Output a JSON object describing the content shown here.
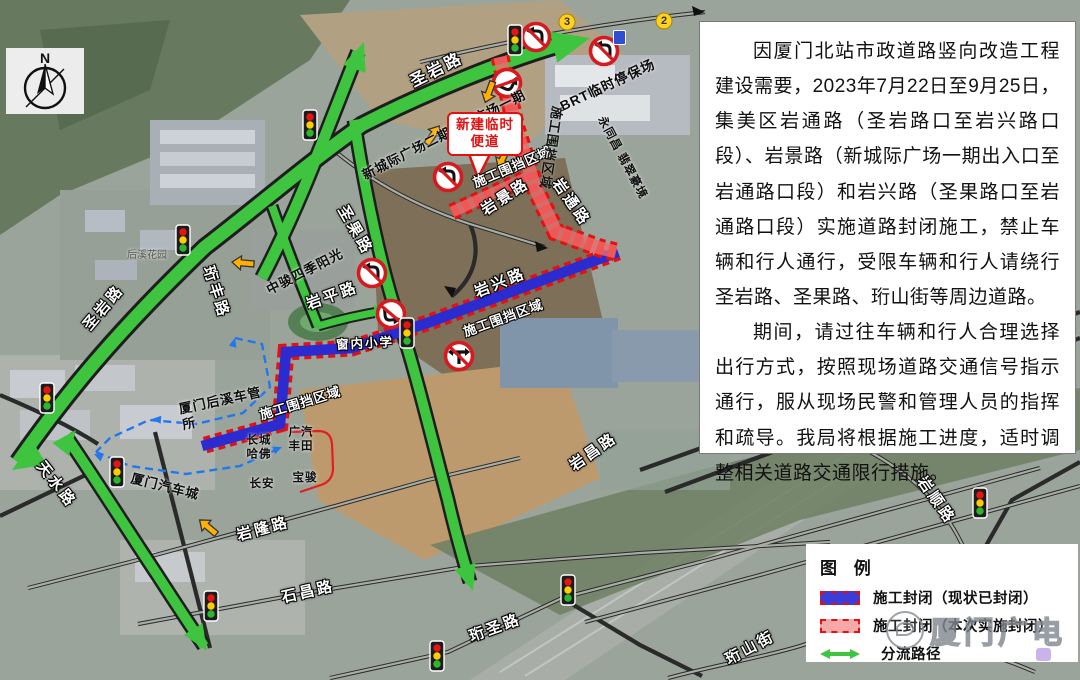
{
  "notice": {
    "p1": "因厦门北站市政道路竖向改造工程建设需要，2023年7月22日至9月25日，集美区岩通路（圣岩路口至岩兴路口段）、岩景路（新城际广场一期出入口至岩通路口段）和岩兴路（圣果路口至岩通路口段）实施道路封闭施工，禁止车辆和行人通行，受限车辆和行人请绕行圣岩路、圣果路、珩山街等周边道路。",
    "p2": "期间，请过往车辆和行人合理选择出行方式，按照现场道路交通信号指示通行，服从现场民警和管理人员的指挥和疏导。我局将根据施工进度，适时调整相关道路交通限行措施。"
  },
  "legend": {
    "title": "图 例",
    "items": [
      {
        "label": "施工封闭（现状已封闭）"
      },
      {
        "label": "施工封闭（本次实施封闭）"
      },
      {
        "label": "分流路径"
      }
    ]
  },
  "watermark": {
    "text": "厦门广电"
  },
  "compass": {
    "label": "N"
  },
  "callout": {
    "line1": "新建临时",
    "line2": "便道"
  },
  "map": {
    "zone_label": "施工围挡区域",
    "road_labels": [
      "圣岩路",
      "圣岩路",
      "天水路",
      "珩丰路",
      "圣果路",
      "岩平路",
      "岩兴路",
      "岩景路",
      "岩通路",
      "岩隆路",
      "石昌路",
      "珩圣路",
      "岩昌路",
      "岩顺路",
      "珩山街"
    ],
    "school_label": "窗内小学",
    "places": [
      "新城际广场二期",
      "广场一期",
      "BRT临时停保场",
      "永同昌 翡翠豪境",
      "中骏四季阳光",
      "厦门汽车城",
      "厦门后溪车管\n所",
      "长城\n哈佛",
      "广汽\n丰田",
      "长安",
      "宝骏",
      "后溪花园"
    ],
    "stop_markers": [
      "3",
      "2"
    ]
  },
  "colors": {
    "route_green": "#3ec43e",
    "closed_now_blue": "#2b2bd0",
    "closed_next_red": "#e33030",
    "legend_pink": "#f7a8a8"
  }
}
